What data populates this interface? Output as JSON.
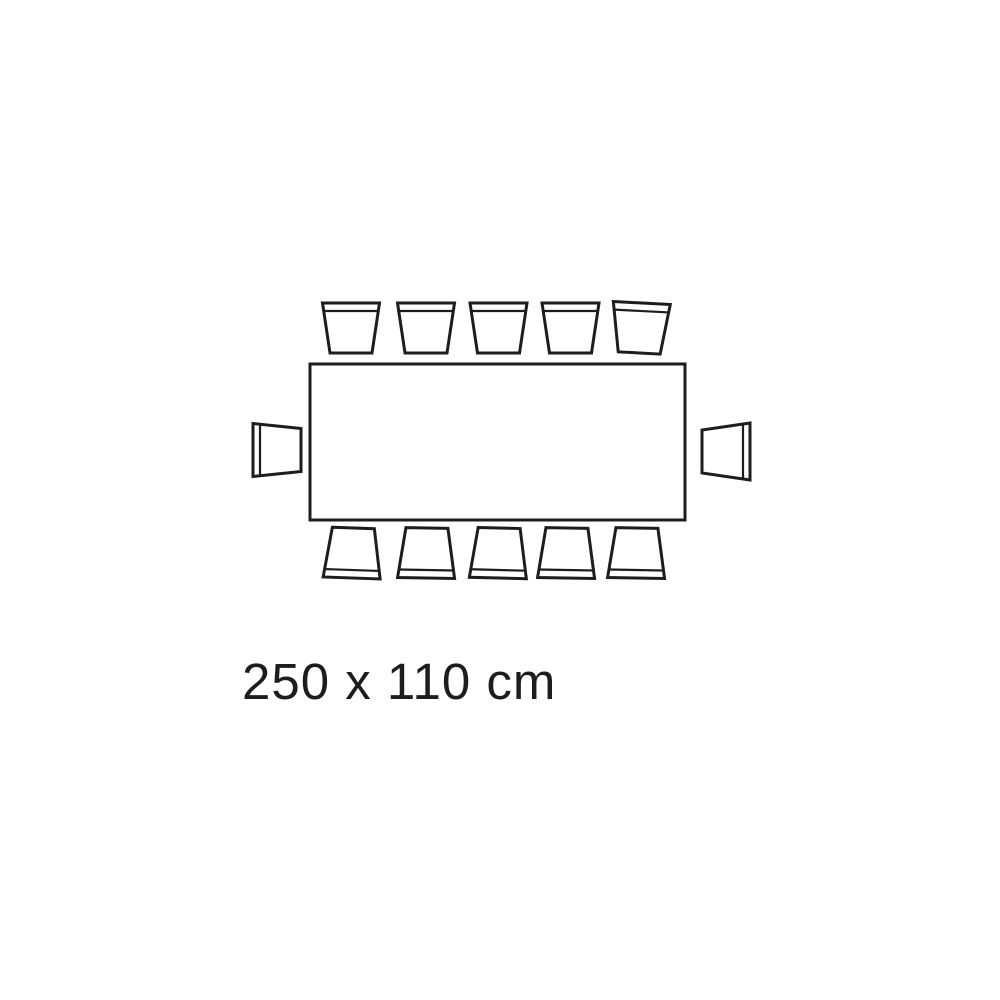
{
  "page": {
    "background_color": "#ffffff"
  },
  "diagram": {
    "type": "table-seating-plan",
    "table_shape": "rectangle",
    "dimensions_label": "250 x 110 cm",
    "seats": {
      "top": 5,
      "bottom": 5,
      "left": 1,
      "right": 1,
      "total": 12
    },
    "stroke_color": "#1d1d1d",
    "fill_color": "#ffffff",
    "label_color": "#1d1d1b"
  }
}
